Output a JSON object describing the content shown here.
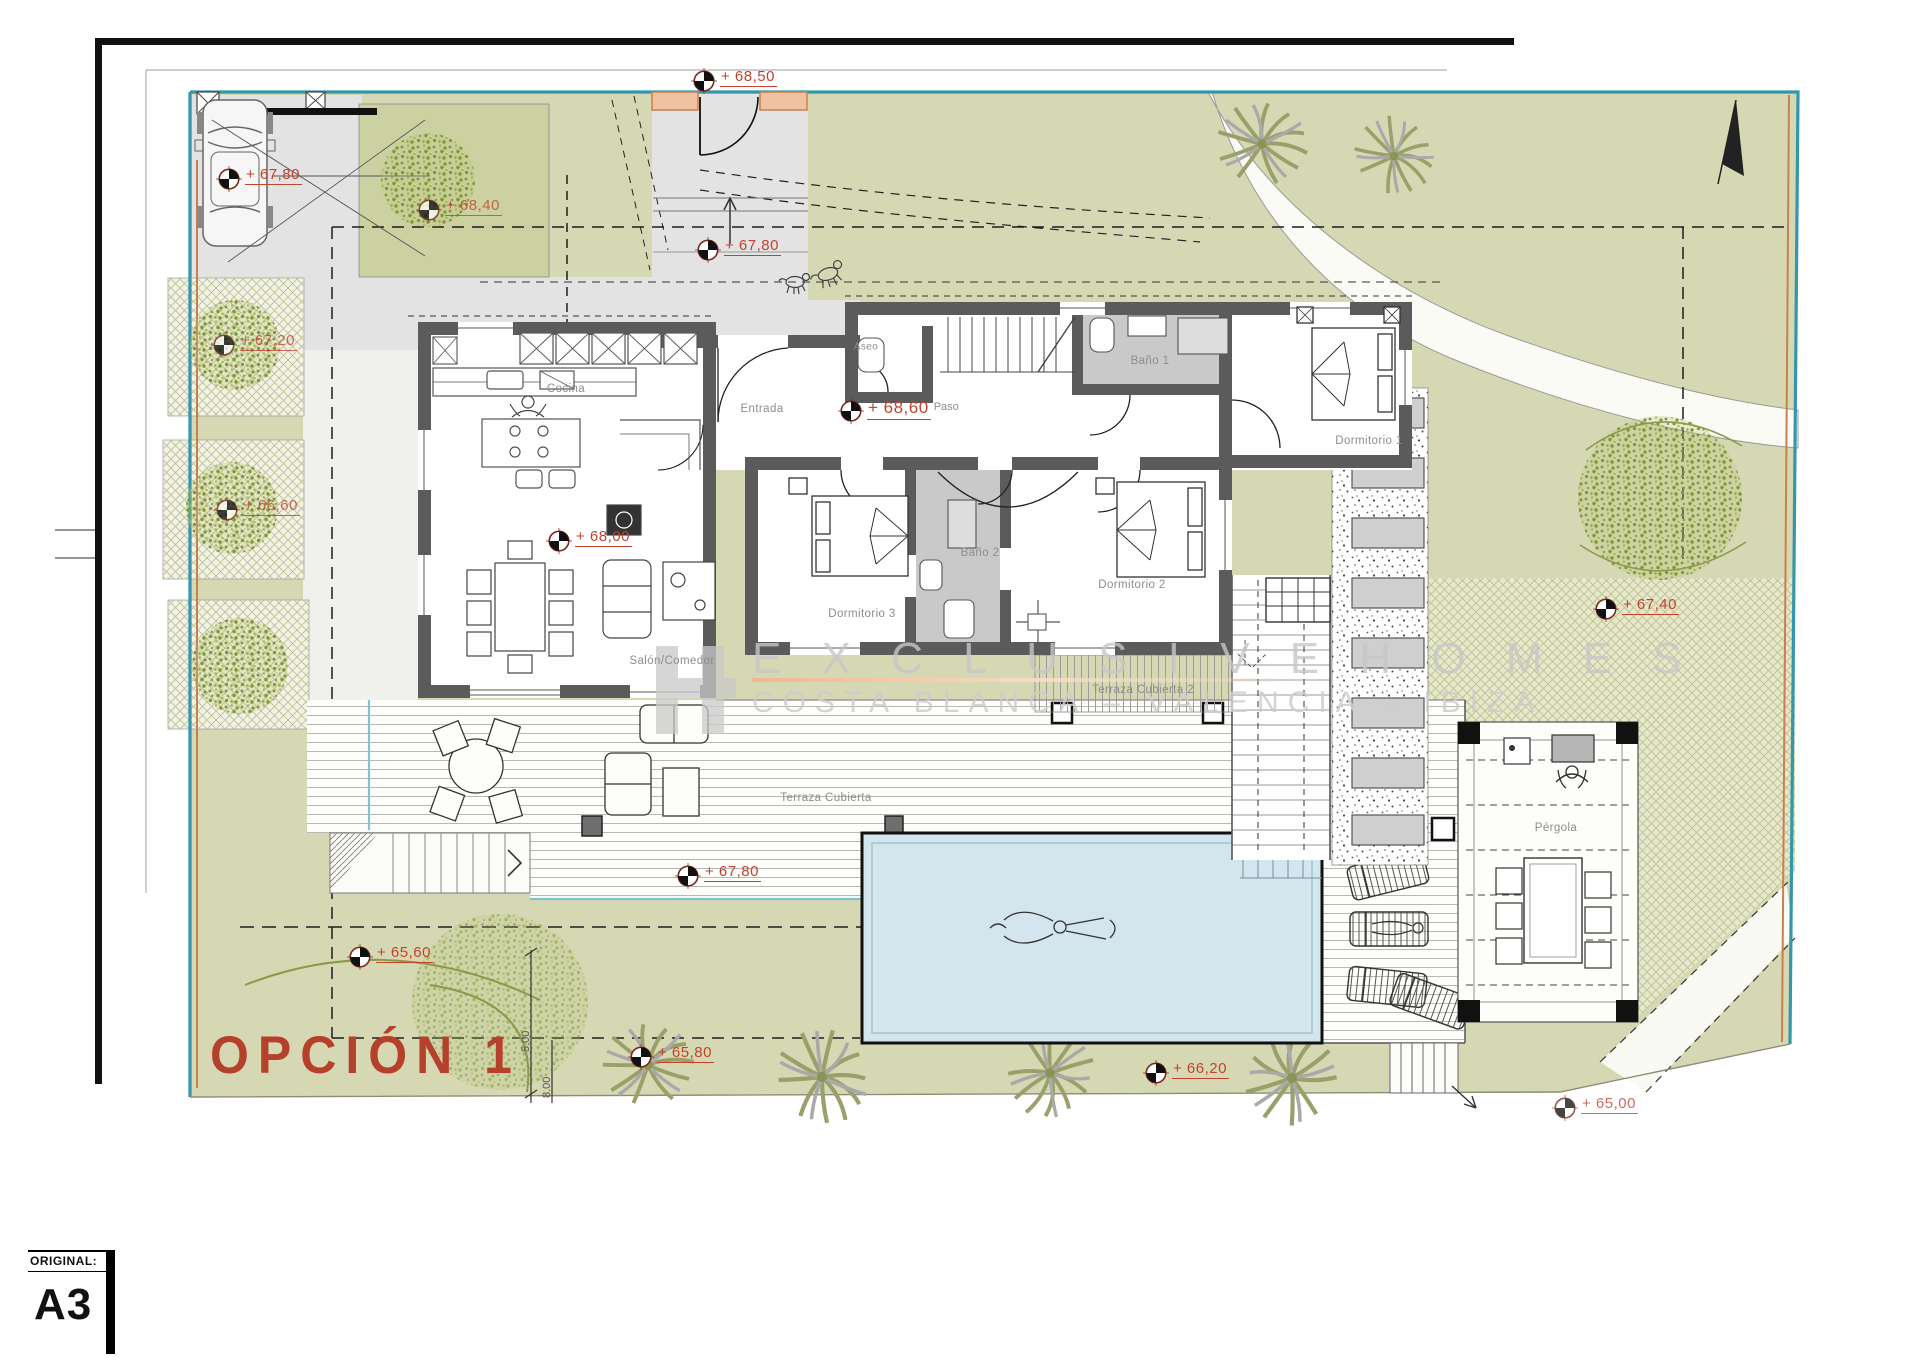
{
  "sheet": {
    "original_label": "ORIGINAL:",
    "format": "A3"
  },
  "plan_title": "OPCIÓN 1",
  "watermark": {
    "line1": "E X C L U S I V E  H O M E S",
    "line2": "COSTA BLANCA  –  VALENCIA  –  IBIZA"
  },
  "rooms": {
    "cocina": "Cocina",
    "entrada": "Entrada",
    "aseo": "Aseo",
    "paso": "Paso",
    "bano1": "Baño 1",
    "bano2": "Baño 2",
    "dormitorio1": "Dormitorio 1",
    "dormitorio2": "Dormitorio 2",
    "dormitorio3": "Dormitorio 3",
    "salon": "Salón/Comedor",
    "terraza": "Terraza Cubierta",
    "terraza2": "Terraza Cubierta 2",
    "pergola": "Pérgola"
  },
  "levels": {
    "gate": "+ 68,50",
    "parking": "+ 67,80",
    "entry_path": "+ 67,80",
    "paso": "+ 68,60",
    "salon": "+ 68,00",
    "terraza": "+ 67,80",
    "garden_sw": "+ 65,60",
    "garden_s": "+ 65,80",
    "pool_south": "+ 66,20",
    "garden_east": "+ 67,40",
    "tree_north": "+ 68,40",
    "garden_w1": "+ 67,20",
    "garden_w2": "+ 66,60",
    "stairs_se": "+ 65,00"
  },
  "dimensions": {
    "d1": "5.00",
    "d2": "8.00"
  },
  "colors": {
    "site_green": "#d6d8b4",
    "plot_green": "#ccd1a2",
    "boundary_teal": "#3396ad",
    "boundary_orange": "#c8804f",
    "wall_gray": "#5b5b5b",
    "bath_floor": "#c9c9c9",
    "pool_blue": "#d3e6ed",
    "marker_red": "#c0432e",
    "title_red": "#b5402c",
    "watermark_gray": "#c9c9c9"
  }
}
